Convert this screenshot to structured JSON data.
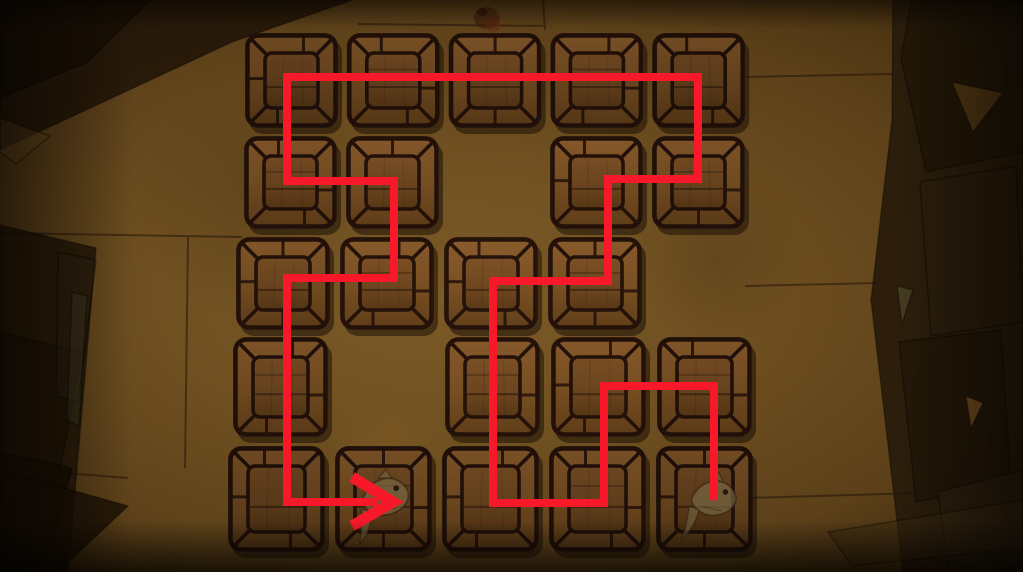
{
  "scene": {
    "name": "wooden-path-memory-puzzle",
    "view": "top-down dungeon floor with grid of wooden tiles and red solution path overlay",
    "colors": {
      "floor_light": "#7c5a27",
      "floor_dark": "#2f1f0a",
      "slab_dark": "#241807",
      "path_red": "#f71826",
      "tile_outline": "#25120a",
      "tile_wood_light": "#8a5c2c",
      "tile_wood_dark": "#66401a",
      "tile_panel_light": "#7d5126",
      "tile_panel_dark": "#5d3a16",
      "tile_rim": "#4f3d19",
      "fish_body": "#7a6a46"
    }
  },
  "grid": {
    "cols": 5,
    "rows": 5,
    "missing_cells": [
      [
        3,
        2
      ],
      [
        5,
        3
      ],
      [
        2,
        4
      ]
    ],
    "rows_layout": [
      {
        "row": 1,
        "left": 245,
        "top": 33,
        "pitch": 101.8,
        "tile_w": 93,
        "tile_h": 95
      },
      {
        "row": 2,
        "left": 244,
        "top": 136,
        "pitch": 102.0,
        "tile_w": 93,
        "tile_h": 93
      },
      {
        "row": 3,
        "left": 236,
        "top": 237,
        "pitch": 104.0,
        "tile_w": 94,
        "tile_h": 93
      },
      {
        "row": 4,
        "left": 233,
        "top": 337,
        "pitch": 106.0,
        "tile_w": 95,
        "tile_h": 100
      },
      {
        "row": 5,
        "left": 228,
        "top": 446,
        "pitch": 107.0,
        "tile_w": 97,
        "tile_h": 106
      }
    ]
  },
  "path": {
    "color": "#f7182a",
    "stroke_width": 8,
    "points": [
      [
        714,
        500
      ],
      [
        714,
        386
      ],
      [
        604,
        386
      ],
      [
        604,
        503
      ],
      [
        493,
        503
      ],
      [
        493,
        281
      ],
      [
        608,
        281
      ],
      [
        608,
        179
      ],
      [
        698,
        179
      ],
      [
        698,
        77
      ],
      [
        287,
        77
      ],
      [
        287,
        181
      ],
      [
        394,
        181
      ],
      [
        394,
        278
      ],
      [
        287,
        278
      ],
      [
        287,
        502
      ],
      [
        378,
        502
      ]
    ],
    "arrow": {
      "chevron": [
        [
          352,
          477
        ],
        [
          393,
          502
        ],
        [
          352,
          526
        ]
      ],
      "stroke_width": 11
    },
    "start_cell": "r5c5",
    "end_cell": "r5c2",
    "cell_sequence": "r5c5 r4c5 r4c4 r5c4 r5c3 r4c3 r3c3 r3c4 r2c4 r2c5 r1c5 r1c4 r1c3 r1c2 r1c1 r2c1 r2c2 r3c2 r3c1 r4c1 r5c1 r5c2"
  },
  "decals": {
    "fish": [
      {
        "cell": "r5c2",
        "cx": 384,
        "cy": 500,
        "rot": -8,
        "scale": 1.0
      },
      {
        "cell": "r5c5",
        "cx": 712,
        "cy": 501,
        "rot": 2,
        "scale": 0.95
      }
    ],
    "debris": {
      "cx": 487,
      "cy": 18
    }
  }
}
